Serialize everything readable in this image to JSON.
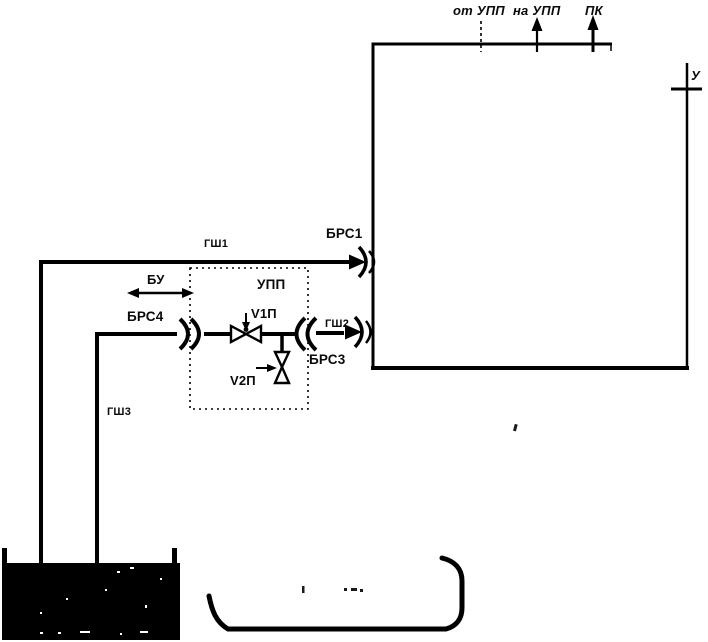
{
  "diagram": {
    "colors": {
      "line": "#000000",
      "background": "#ffffff"
    },
    "top_ports": [
      {
        "label": "от УПП"
      },
      {
        "label": "на УПП"
      },
      {
        "label": "ПК"
      }
    ],
    "right_port": {
      "label": "У"
    },
    "couplings": {
      "brs1": "БРС1",
      "brs3": "БРС3",
      "brs4": "БРС4"
    },
    "hoses": {
      "gsh1": "ГШ1",
      "gsh2": "ГШ2",
      "gsh3": "ГШ3"
    },
    "valves": {
      "v1p": "V1П",
      "v2p": "V2П"
    },
    "units": {
      "upp": "УПП",
      "bu": "БУ"
    }
  }
}
